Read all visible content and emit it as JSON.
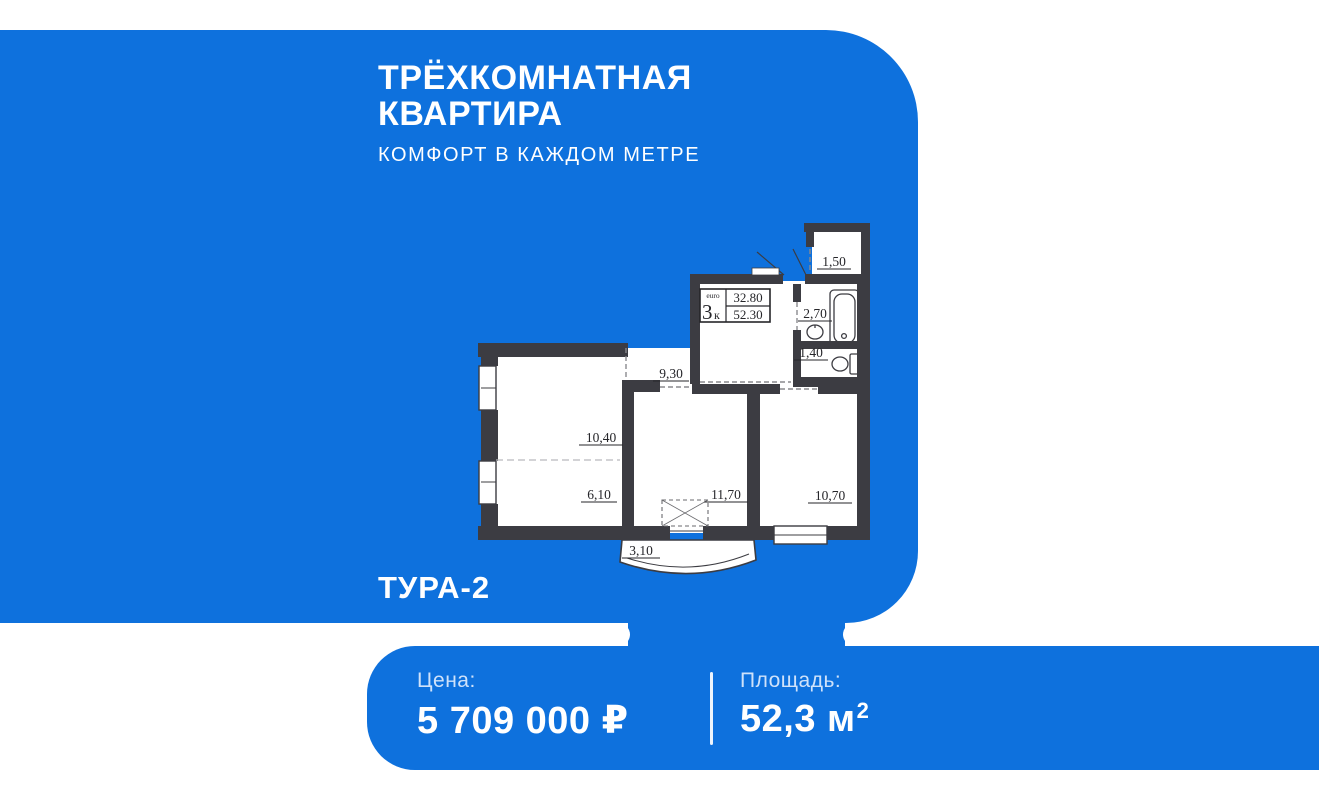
{
  "colors": {
    "brand_blue": "#0e71dd",
    "plan_wall": "#3c3c42",
    "footer_label_text": "#cfe2fa",
    "title_text": "#ffffff"
  },
  "header": {
    "title_line1": "ТРЁХКОМНАТНАЯ",
    "title_line2": "КВАРТИРА",
    "subtitle": "КОМФОРТ В КАЖДОМ МЕТРЕ"
  },
  "plan": {
    "name": "ТУРА-2",
    "stamp": {
      "tag": "euro",
      "digit": "3",
      "letter": "к",
      "upper_value": "32.80",
      "lower_value": "52.30"
    },
    "rooms": [
      {
        "name": "storage",
        "area": "1,50"
      },
      {
        "name": "bathroom",
        "area": "2,70"
      },
      {
        "name": "wc",
        "area": "1,40"
      },
      {
        "name": "hallway",
        "area": "9,30"
      },
      {
        "name": "kitchen-living",
        "area": "10,40"
      },
      {
        "name": "room-six",
        "area": "6,10"
      },
      {
        "name": "bedroom-center",
        "area": "11,70"
      },
      {
        "name": "bedroom-right",
        "area": "10,70"
      },
      {
        "name": "balcony",
        "area": "3,10"
      }
    ]
  },
  "footer": {
    "price_label": "Цена:",
    "price_value": "5 709 000 ₽",
    "area_label": "Площадь:",
    "area_value": "52,3 м",
    "area_sup": "2"
  }
}
